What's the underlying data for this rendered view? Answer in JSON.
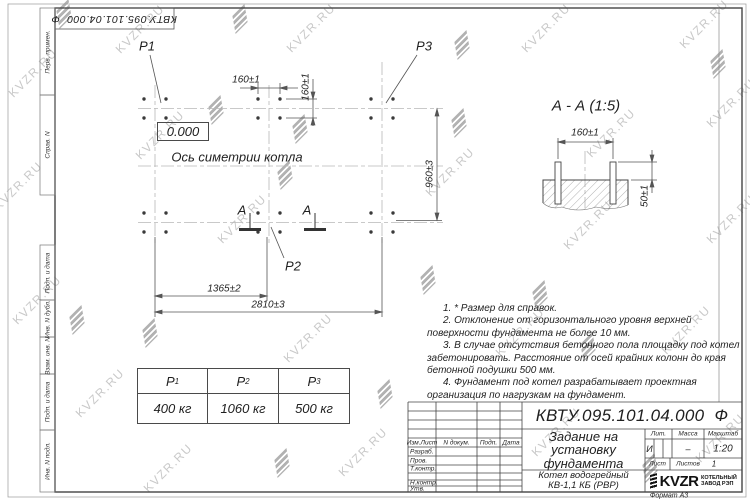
{
  "sheet": {
    "top_stamp": "КВТУ.095.101.04.000  Ф",
    "format_label": "Формат А3",
    "margin_labels": [
      "Перв. примен.",
      "Справ. N",
      "Подп. и дата",
      "Инв. N дубл.",
      "Взам. инв. N",
      "Подп. и дата",
      "Инв. N подл."
    ]
  },
  "watermark": {
    "text": "KVZR.RU"
  },
  "plan": {
    "p1": "P1",
    "p2": "P2",
    "p3": "P3",
    "level_mark": "0.000",
    "axis_label": "Ось симетрии котла",
    "section_letter": "А",
    "dim_bolt_spacing_h": "160±1",
    "dim_bolt_spacing_v": "160±1",
    "dim_width": "960±3",
    "dim_left_to_center": "1365±2",
    "dim_total_length": "2810±3"
  },
  "section_view": {
    "title": "А - А (1:5)",
    "dim_bolt_spacing": "160±1",
    "dim_bolt_height": "50±1"
  },
  "notes": [
    "1. * Размер для справок.",
    "2. Отклонение от горизонтального уровня верхней поверхности фундамента не более 10 мм.",
    "3. В случае отсутствия бетонного пола площадку под котел забетонировать. Расстояние от осей крайних колонн до края бетонной подушки 500 мм.",
    "4. Фундамент под котел разрабатывает проектная организация по нагрузкам на фундамент."
  ],
  "load_table": {
    "columns": [
      {
        "symbol": "P",
        "sub": "1",
        "value": "400 кг"
      },
      {
        "symbol": "P",
        "sub": "2",
        "value": "1060 кг"
      },
      {
        "symbol": "P",
        "sub": "3",
        "value": "500 кг"
      }
    ]
  },
  "title_block": {
    "designation": "КВТУ.095.101.04.000  Ф",
    "doc_title": "Задание на установку фундамента",
    "product": "Котел водогрейный КВ-1,1 КБ (РВР)",
    "header_cols": [
      "Изм.Лист",
      "N докум.",
      "Подп.",
      "Дата"
    ],
    "sign_rows": [
      "Разраб.",
      "Пров.",
      "Т.контр.",
      "Н.контр.",
      "Утв."
    ],
    "lit_label": "Лит.",
    "lit_value": "И",
    "mass_label": "Масса",
    "mass_value": "–",
    "scale_label": "Масштаб",
    "scale_value": "1:20",
    "sheet_label": "Лист",
    "sheets_label": "Листов",
    "sheets_value": "1",
    "logo_text": "KVZR",
    "logo_caption_line1": "КОТЕЛЬНЫЙ",
    "logo_caption_line2": "ЗАВОД РЭП"
  }
}
